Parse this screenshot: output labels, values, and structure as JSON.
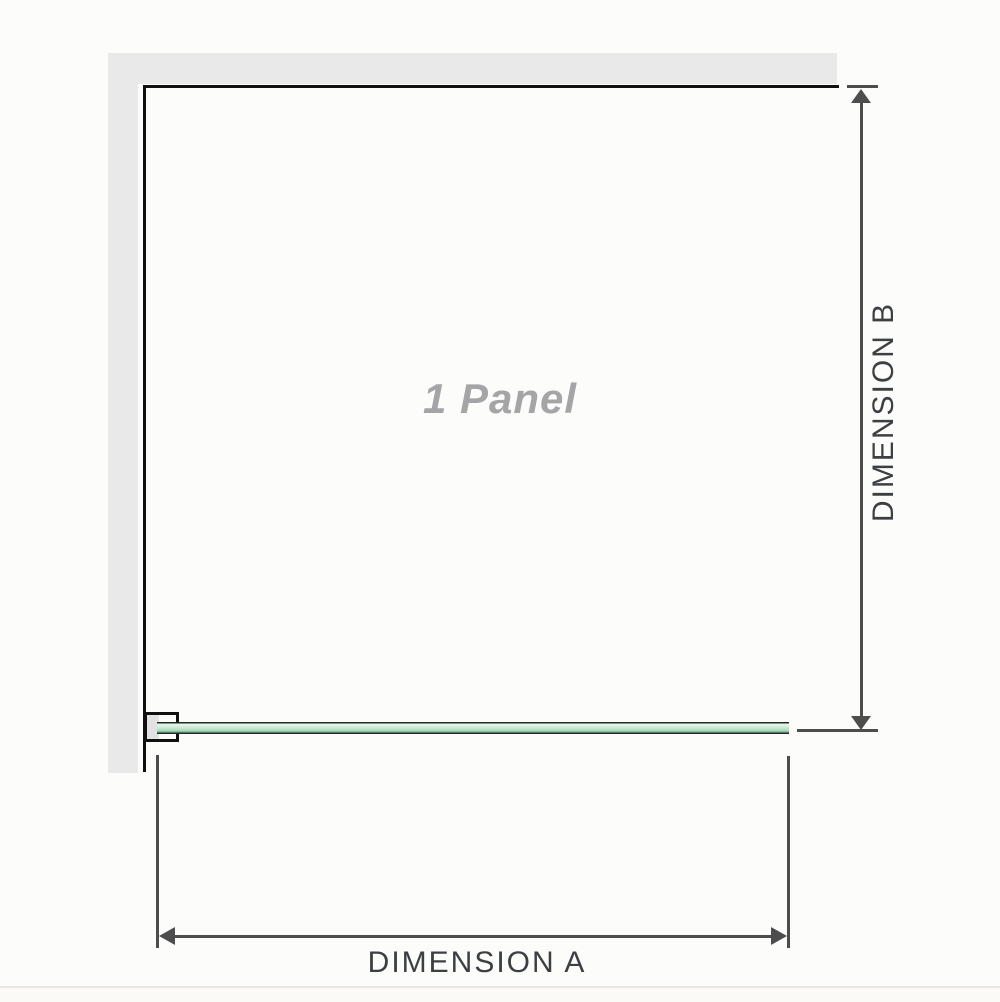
{
  "diagram": {
    "type": "shower-screen-dimension-diagram",
    "panel_label": "1 Panel",
    "dimension_a_label": "DIMENSION A",
    "dimension_b_label": "DIMENSION B"
  },
  "colors": {
    "background": "#fcfcfb",
    "wall": "#e9e9e9",
    "panel_outline": "#101010",
    "dimension_line": "#4d4d4d",
    "dimension_text": "#3d4043",
    "panel_label_text": "#a5a5a7",
    "glass_light": "#e8f6ec",
    "glass_mid": "#b9e2c8",
    "glass_dark": "#638f72",
    "glass_border": "#1e2a22"
  }
}
